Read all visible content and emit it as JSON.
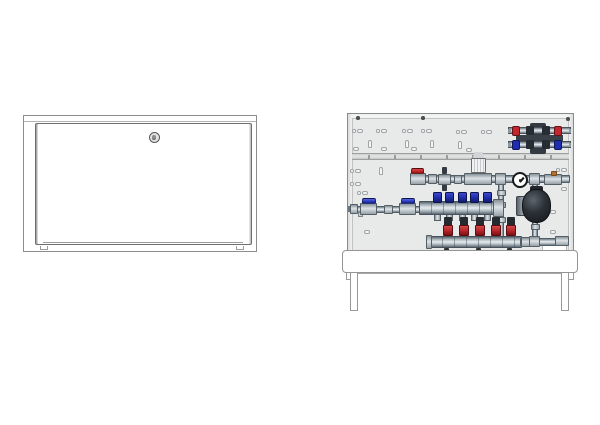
{
  "drawing": {
    "kind": "technical product illustration, two views, no text",
    "left_view": "floor-heating manifold cabinet, door closed, cylinder lock at top centre",
    "right_view": "same cabinet open, showing mixing unit and manifolds on perforated back panel with floor stand"
  },
  "colors": {
    "panel": "#e8e9e9",
    "pipe_edge": "#515d66",
    "red_handle": "#c1272d",
    "blue_handle": "#2a3cc2",
    "flow_meter_cap": "#1f2da6",
    "return_cap_red": "#b3242a",
    "valve_top_dark": "#262b32",
    "brass": "#b5722f",
    "pump_dark": "#1c2025",
    "line": "#8a8a8a"
  },
  "left_cabinet": {
    "lock_icon": "cylinder-lock-icon",
    "door_tabs": 2
  },
  "right_cabinet": {
    "components": [
      "heat-meter-connection-set (red supply valves / blue return valves)",
      "supply line with red ball valve, thermostatic mixing valve head, pressure gauge, air vent",
      "circulation pump",
      "supply manifold with 5 blue flow-meter caps and 2 blue ball valves",
      "return manifold with 5 red valve caps",
      "blank label plate",
      "slotted mounting rail",
      "perforated back panel"
    ],
    "flow_meters": {
      "count": 5,
      "centers": [
        89,
        101.5,
        114,
        126.5,
        139
      ],
      "cap_y": 78,
      "nip_y": 99
    },
    "return_valves": {
      "count": 5,
      "centers": [
        100,
        116,
        132,
        147.5,
        163
      ],
      "top_y": 103,
      "red_y": 111
    },
    "drain_nubs": {
      "centers": [
        98,
        130,
        161
      ],
      "y": 134
    },
    "rail_ticks": [
      16,
      42,
      68,
      94,
      120,
      146,
      172,
      198
    ],
    "panel_holes": [
      {
        "shape": "pair",
        "x": 4,
        "y": 15
      },
      {
        "shape": "pair",
        "x": 28,
        "y": 15
      },
      {
        "shape": "pair",
        "x": 54,
        "y": 15
      },
      {
        "shape": "pair",
        "x": 73,
        "y": 15
      },
      {
        "shape": "pair",
        "x": 108,
        "y": 16
      },
      {
        "shape": "pair",
        "x": 133,
        "y": 16
      },
      {
        "shape": "keyhole",
        "x": 20,
        "y": 26
      },
      {
        "shape": "keyhole",
        "x": 57,
        "y": 26
      },
      {
        "shape": "keyhole",
        "x": 82,
        "y": 26
      },
      {
        "shape": "keyhole",
        "x": 110,
        "y": 27
      },
      {
        "shape": "slot",
        "x": 5,
        "y": 33
      },
      {
        "shape": "slot",
        "x": 33,
        "y": 33
      },
      {
        "shape": "slot",
        "x": 63,
        "y": 33
      },
      {
        "shape": "slot",
        "x": 118,
        "y": 34
      },
      {
        "shape": "pair",
        "x": 2,
        "y": 55
      },
      {
        "shape": "keyhole",
        "x": 31,
        "y": 53
      },
      {
        "shape": "pair",
        "x": 208,
        "y": 54
      },
      {
        "shape": "pair",
        "x": 2,
        "y": 68
      },
      {
        "shape": "pair",
        "x": 9,
        "y": 77
      },
      {
        "shape": "slot",
        "x": 213,
        "y": 73
      },
      {
        "shape": "slot",
        "x": 202,
        "y": 96
      },
      {
        "shape": "slot",
        "x": 202,
        "y": 116
      },
      {
        "shape": "slot",
        "x": 16,
        "y": 116
      },
      {
        "shape": "screw",
        "x": 8,
        "y": 2
      },
      {
        "shape": "screw",
        "x": 73,
        "y": 2
      },
      {
        "shape": "screw",
        "x": 218,
        "y": 3
      }
    ]
  }
}
